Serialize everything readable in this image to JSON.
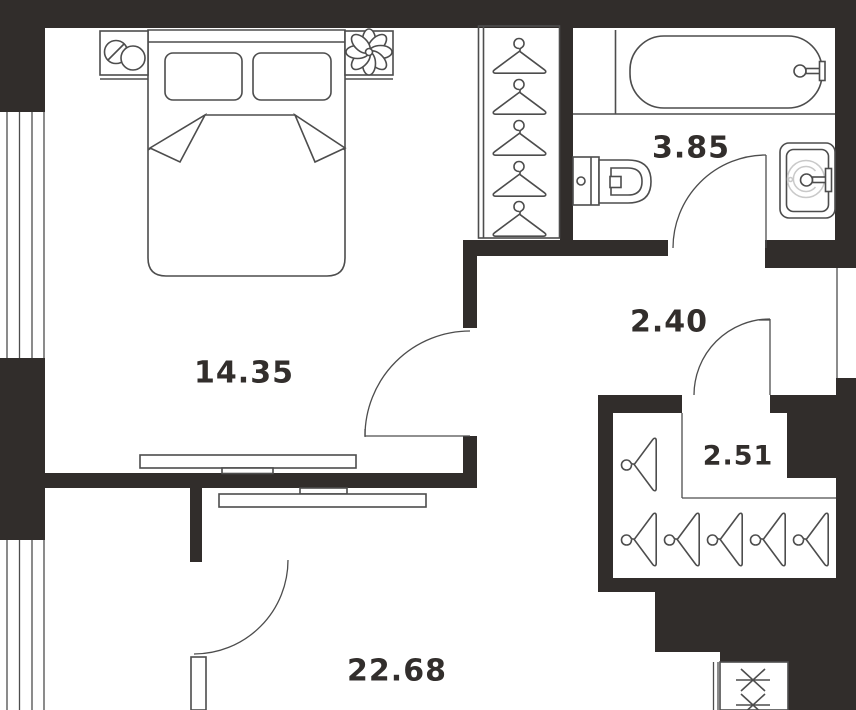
{
  "title": "apartment-floor-plan",
  "colors": {
    "wall": "#312d2b",
    "line": "#4d4d4d",
    "light_line": "#c9c9c9",
    "label": "#322e2c",
    "bg": "#ffffff"
  },
  "rooms": {
    "bedroom": {
      "name": "bedroom",
      "label": "14.35"
    },
    "bathroom": {
      "name": "bathroom",
      "label": "3.85"
    },
    "hallway": {
      "name": "hallway",
      "label": "2.40"
    },
    "closet": {
      "name": "closet",
      "label": "2.51"
    },
    "living": {
      "name": "living-room",
      "label": "22.68"
    }
  }
}
